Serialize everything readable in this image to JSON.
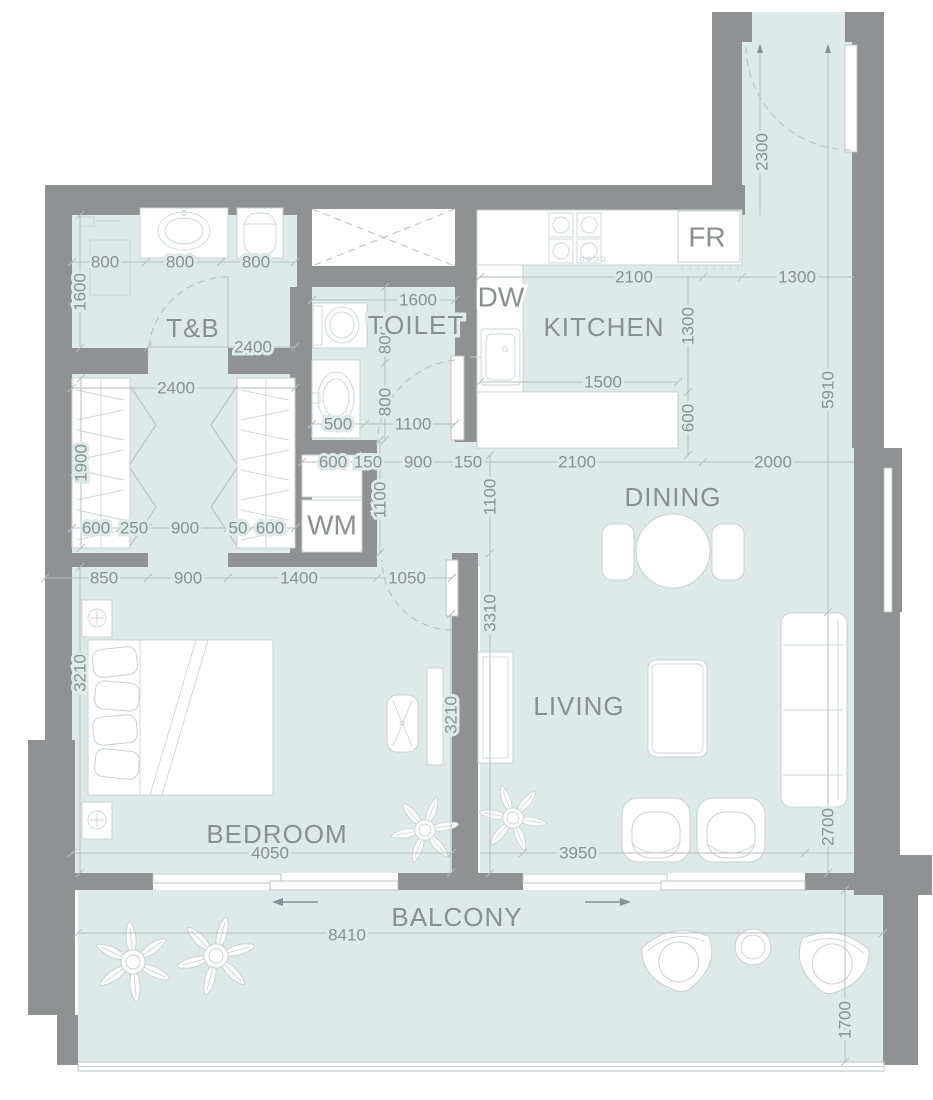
{
  "title": "Apartment Unit Floor Plan",
  "colors": {
    "floor": "#dee9e9",
    "wall": "#8f9193",
    "fixture": "#ffffff",
    "dim_line": "#b6bebf",
    "dim_text": "#8b9092",
    "room_text": "#8a8f91"
  },
  "rooms": {
    "tnb": "T&B",
    "toilet": "TOILET",
    "kitchen": "KITCHEN",
    "dining": "DINING",
    "living": "LIVING",
    "bedroom": "BEDROOM",
    "balcony": "BALCONY"
  },
  "appliances": {
    "wm": "WM",
    "dw": "DW",
    "fr": "FR"
  },
  "dims": {
    "shower_w": "800",
    "sink_w": "800",
    "wc_w": "800",
    "tnb_d": "1600",
    "tnb_door": "2400",
    "closet_w": "2400",
    "closet_d": "1900",
    "ward_l": "600",
    "gap_l": "250",
    "closet_aisle": "900",
    "gap_r": "50",
    "ward_r": "600",
    "bed1": "850",
    "bed2": "900",
    "bed3": "1400",
    "bed4": "1050",
    "bed_d": "3210",
    "bed_w": "4050",
    "wm_w": "600",
    "wm_gap": "150",
    "vest_w": "900",
    "wall_150": "150",
    "pass_2100": "2100",
    "din_2000": "2000",
    "basin_500": "500",
    "toi_door": "1100",
    "toi_w": "1600",
    "toi_800a": "800",
    "toi_800b": "800",
    "kit_w": "2100",
    "kit_d": "1300",
    "island_w": "1500",
    "island_d": "600",
    "entry_d": "2300",
    "entry_w": "1300",
    "side_5910": "5910",
    "vest_d": "1100",
    "din_d": "1100",
    "liv_d": "3310",
    "tv_wall": "3210",
    "liv_w": "3950",
    "sofa_2700": "2700",
    "bal_w": "8410",
    "bal_d": "1700"
  }
}
